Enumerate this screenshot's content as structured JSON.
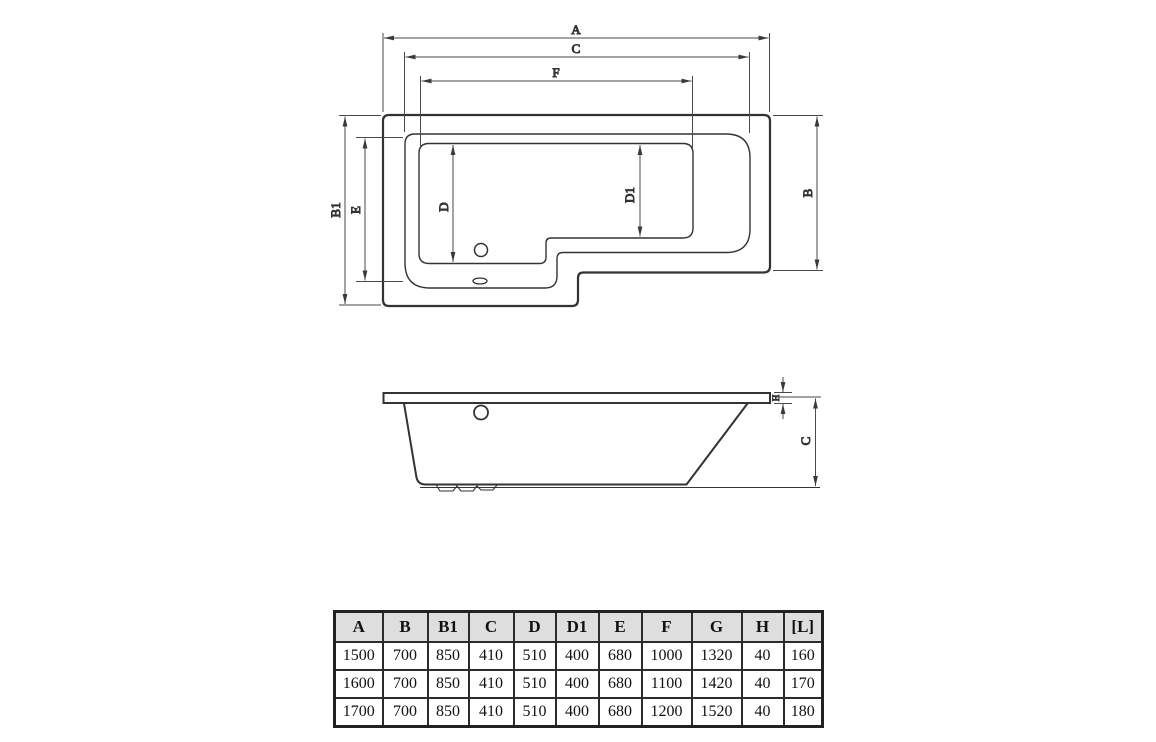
{
  "drawing": {
    "line_color": "#333333",
    "plan_view": {
      "dim_labels": {
        "a": "A",
        "c": "C",
        "f": "F",
        "b1": "B1",
        "e": "E",
        "b": "B",
        "d": "D",
        "d1": "D1"
      }
    },
    "side_view": {
      "dim_labels": {
        "h": "H",
        "c": "C"
      }
    }
  },
  "spec_table": {
    "headers": [
      "A",
      "B",
      "B1",
      "C",
      "D",
      "D1",
      "E",
      "F",
      "G",
      "H",
      "[L]"
    ],
    "rows": [
      [
        "1500",
        "700",
        "850",
        "410",
        "510",
        "400",
        "680",
        "1000",
        "1320",
        "40",
        "160"
      ],
      [
        "1600",
        "700",
        "850",
        "410",
        "510",
        "400",
        "680",
        "1100",
        "1420",
        "40",
        "170"
      ],
      [
        "1700",
        "700",
        "850",
        "410",
        "510",
        "400",
        "680",
        "1200",
        "1520",
        "40",
        "180"
      ]
    ]
  },
  "colors": {
    "line": "#333333",
    "dim_line": "#4a4a4a",
    "table_border": "#2b2b2b",
    "table_header_bg": "#dedede",
    "background": "#ffffff"
  }
}
